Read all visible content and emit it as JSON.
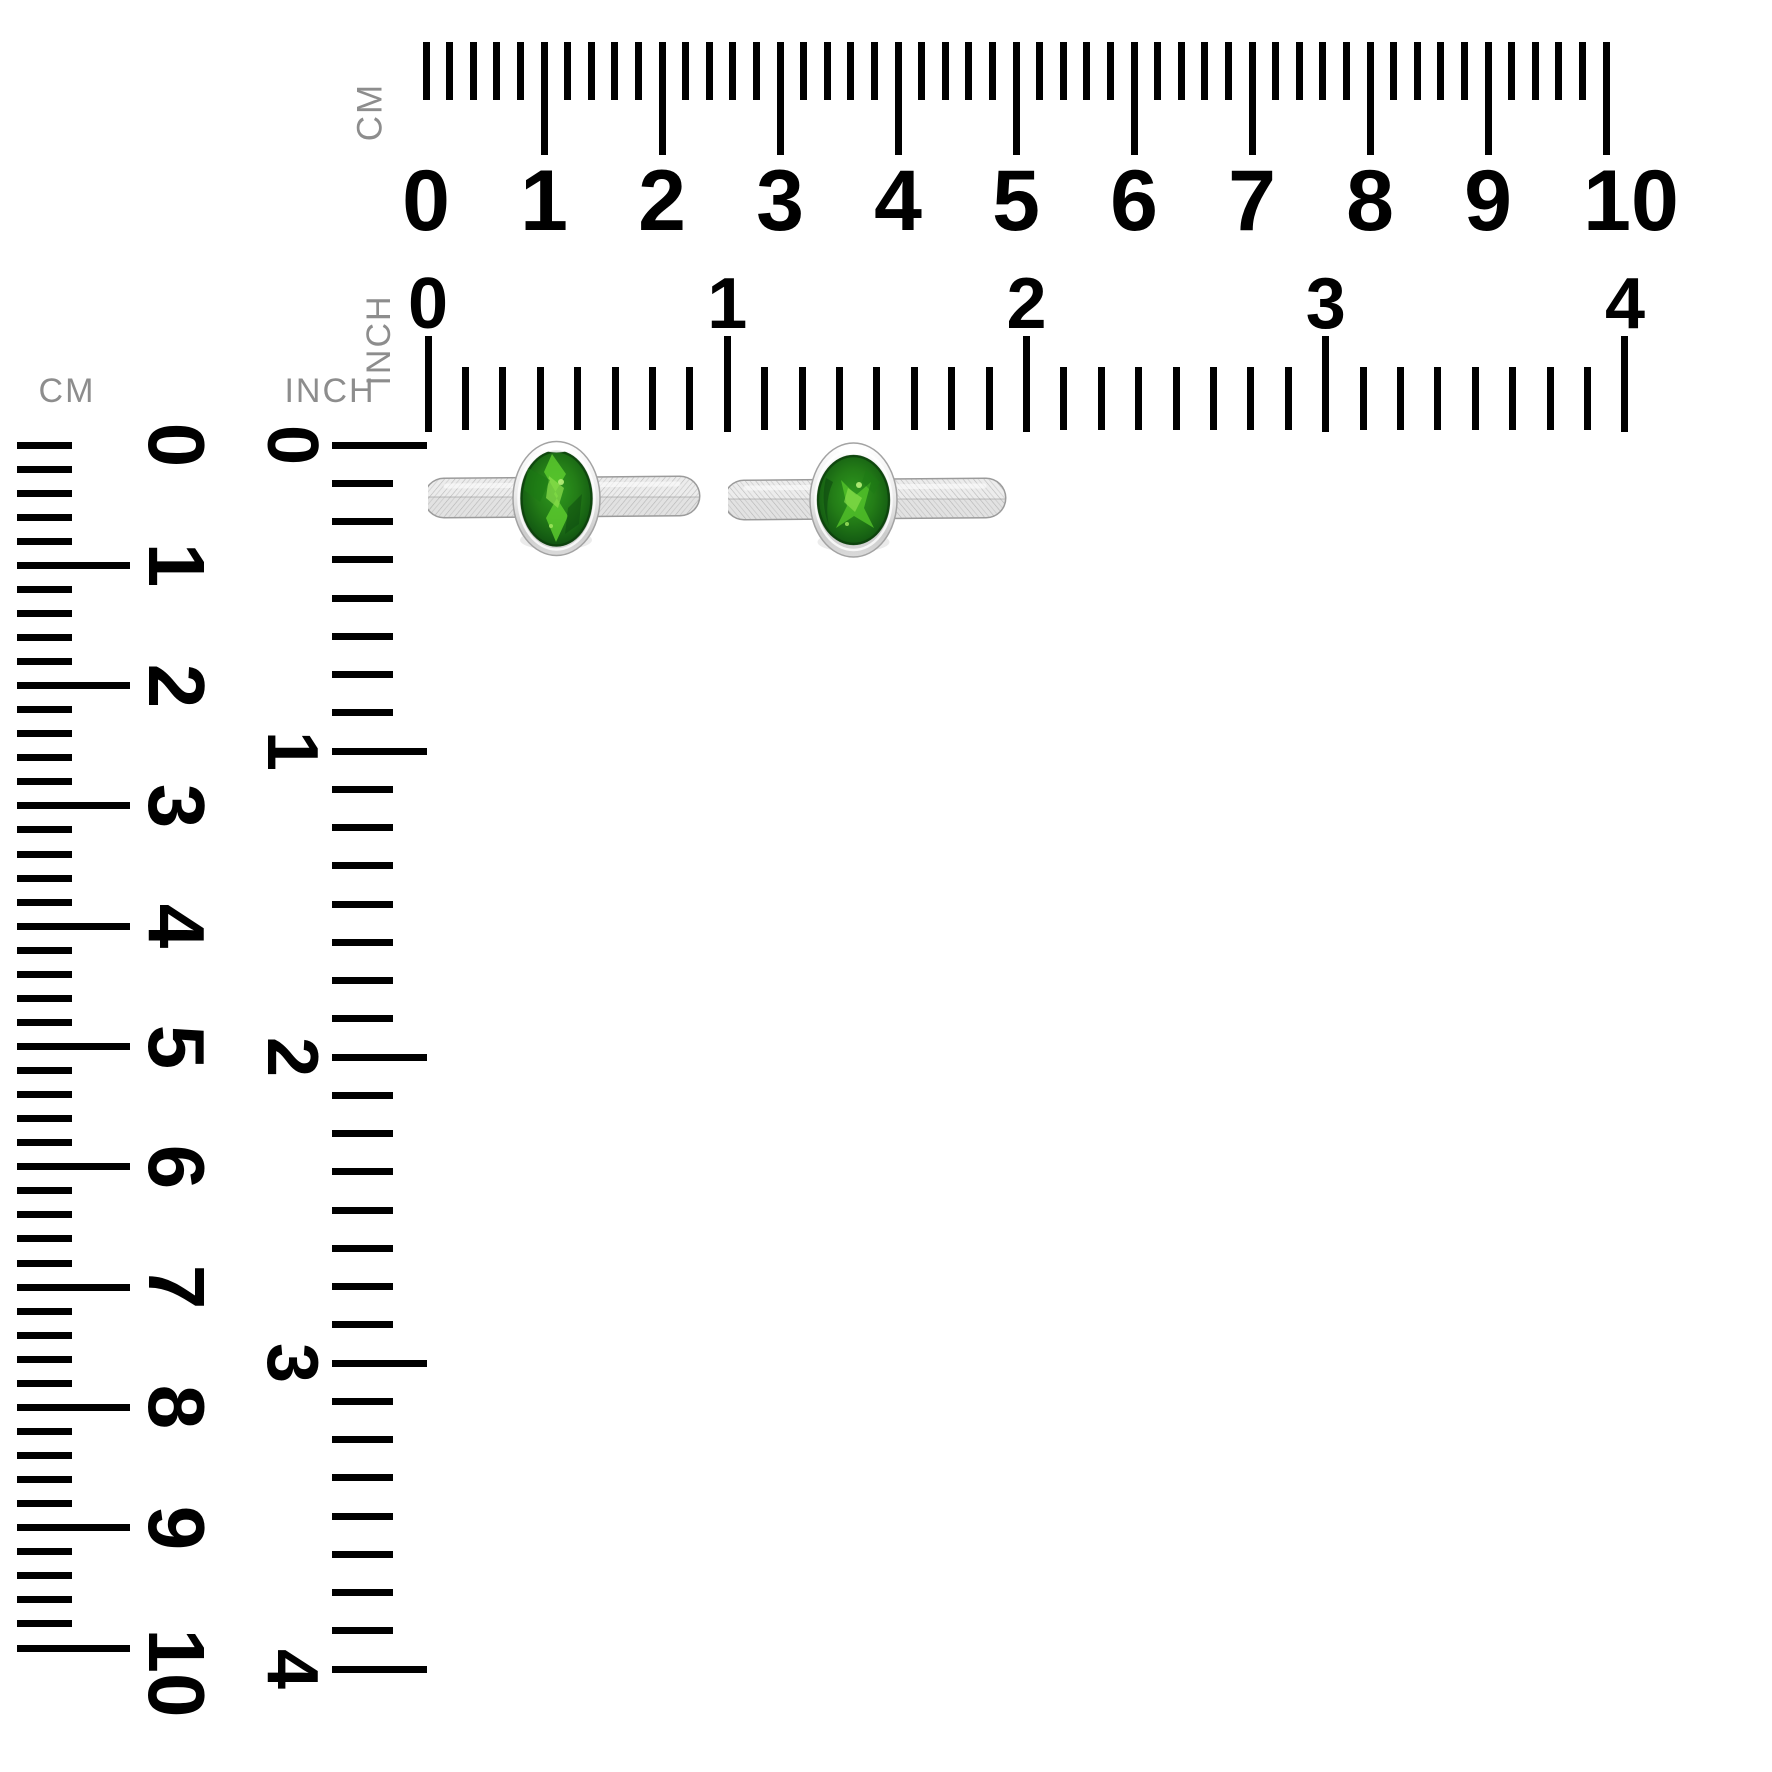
{
  "rulers": {
    "cm_horizontal": {
      "unit": "CM",
      "numbers": [
        "0",
        "1",
        "2",
        "3",
        "4",
        "5",
        "6",
        "7",
        "8",
        "9",
        "10"
      ],
      "minor_division": "2mm"
    },
    "inch_horizontal": {
      "unit": "INCH",
      "numbers": [
        "0",
        "1",
        "2",
        "3",
        "4"
      ],
      "minor_division": "1/8 inch"
    },
    "cm_vertical": {
      "unit": "CM",
      "numbers": [
        "0",
        "1",
        "2",
        "3",
        "4",
        "5",
        "6",
        "7",
        "8",
        "9",
        "10"
      ],
      "minor_division": "2mm"
    },
    "inch_vertical": {
      "unit": "INCH",
      "numbers": [
        "0",
        "1",
        "2",
        "3",
        "4"
      ],
      "minor_division": "1/8 inch"
    }
  },
  "product": {
    "description": "Two silver open-band rings with bezel-set oval green gemstones",
    "items": [
      {
        "name": "green gemstone ring",
        "position": "left"
      },
      {
        "name": "green gemstone ring",
        "position": "right"
      }
    ]
  },
  "colors": {
    "background": "#ffffff",
    "tick": "#000000",
    "number": "#000000",
    "unit_label_gray": "#8d8d8d",
    "gem_green_dark": "#0d4510",
    "gem_green_base": "#1d6b1b",
    "gem_green_highlight": "#55c82d",
    "gem_green_sparkle": "#8ee04e",
    "metal_silver_light": "#f2f2f2",
    "metal_silver_mid": "#c6c6c6",
    "metal_silver_dark": "#9a9a9a"
  }
}
